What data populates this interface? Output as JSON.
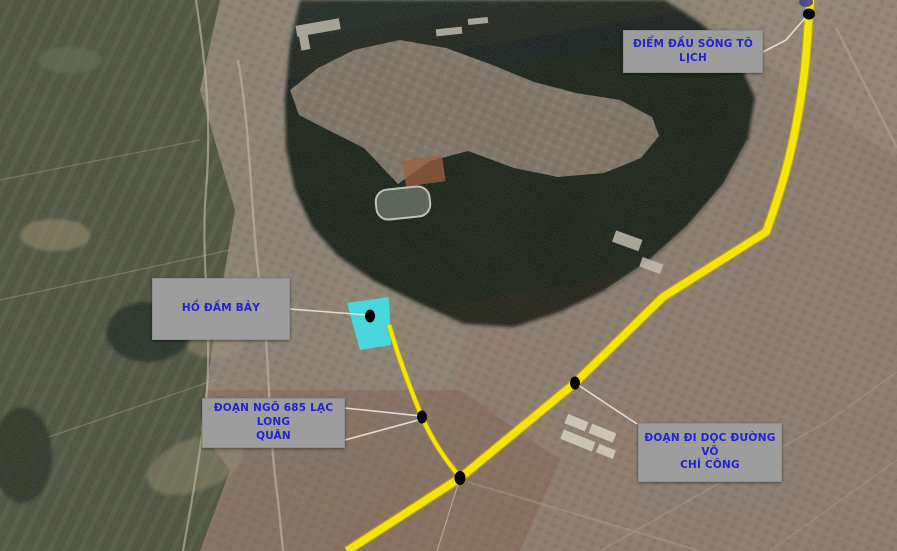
{
  "figure": {
    "callouts": {
      "start_point": "ĐIỂM ĐẦU SÔNG TÔ LỊCH",
      "ho_dam_bay": "HỒ ĐẦM BẢY",
      "ngo_685": "ĐOẠN NGÕ 685 LẠC LONG\nQUÂN",
      "vo_chi_cong": "ĐOẠN ĐI DỌC ĐƯỜNG VÕ\nCHÍ CÔNG"
    },
    "colors": {
      "route": "#f4e40a",
      "route_edge": "#c9ae00",
      "highlight": "#3de2ea",
      "marker": "#000000",
      "leader": "#e9e9e9",
      "label_bg": "#9d9d9d",
      "label_text": "#2222cf"
    },
    "markers": [
      {
        "name": "route-start-dot",
        "linked_callout": "start_point"
      },
      {
        "name": "ho-dam-bay-dot",
        "linked_callout": "ho_dam_bay"
      },
      {
        "name": "ngo-685-dot",
        "linked_callout": "ngo_685"
      },
      {
        "name": "vo-chi-cong-dot",
        "linked_callout": "vo_chi_cong"
      },
      {
        "name": "route-junction-dot",
        "linked_callout": ""
      }
    ]
  }
}
